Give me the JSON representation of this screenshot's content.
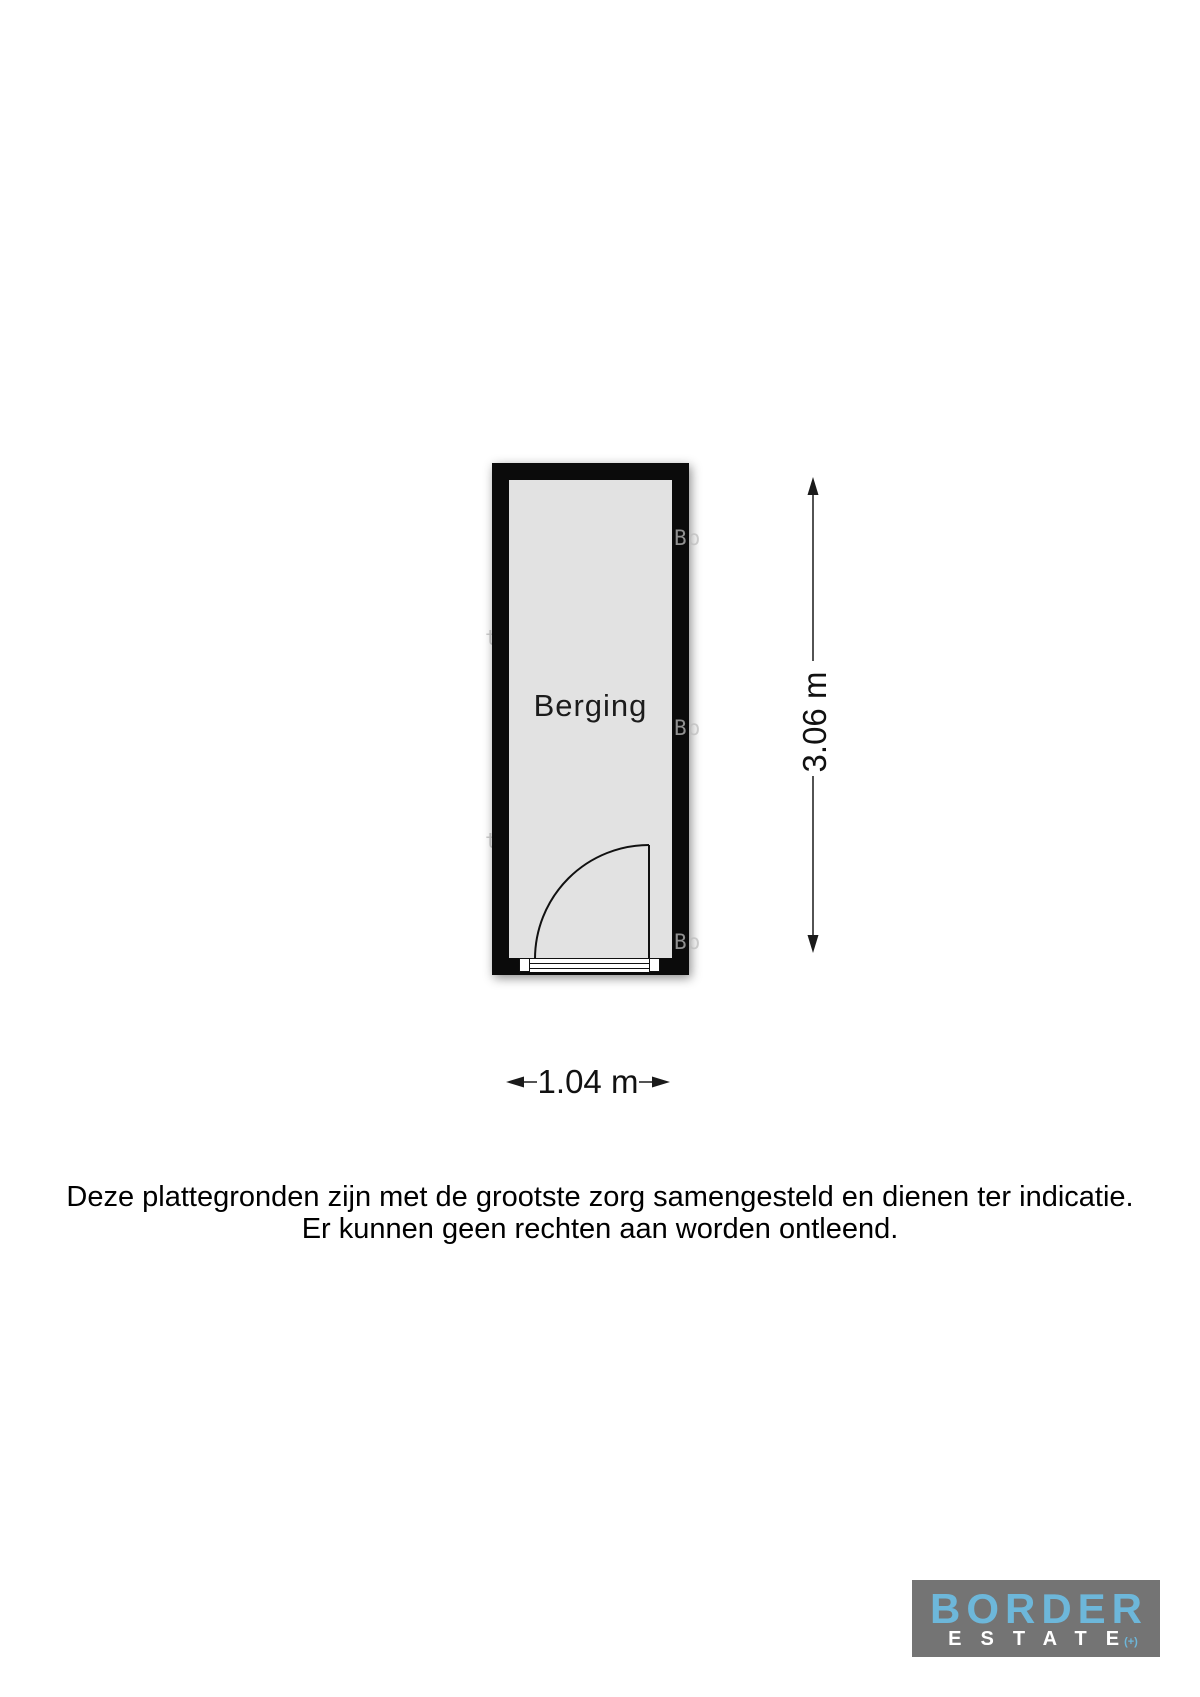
{
  "floorplan": {
    "room": {
      "label": "Berging"
    },
    "dimensions": {
      "width": "1.04 m",
      "height": "3.06 m"
    }
  },
  "disclaimer": {
    "line1": "Deze plattegronden zijn met de grootste zorg samengesteld en dienen ter indicatie.",
    "line2": "Er kunnen geen rechten aan worden ontleend."
  },
  "watermark": {
    "fragment_bo": "Bo",
    "fragment_te": "te+"
  },
  "logo": {
    "name": "BORDER",
    "subtitle": "ESTATE",
    "suffix": "(+)",
    "colors": {
      "background": "#747474",
      "name": "#6db7da",
      "subtitle": "#ffffff"
    }
  },
  "colors": {
    "wall": "#0b0b0b",
    "room_fill": "#e2e2e2",
    "linework": "#111111",
    "background": "#ffffff"
  }
}
